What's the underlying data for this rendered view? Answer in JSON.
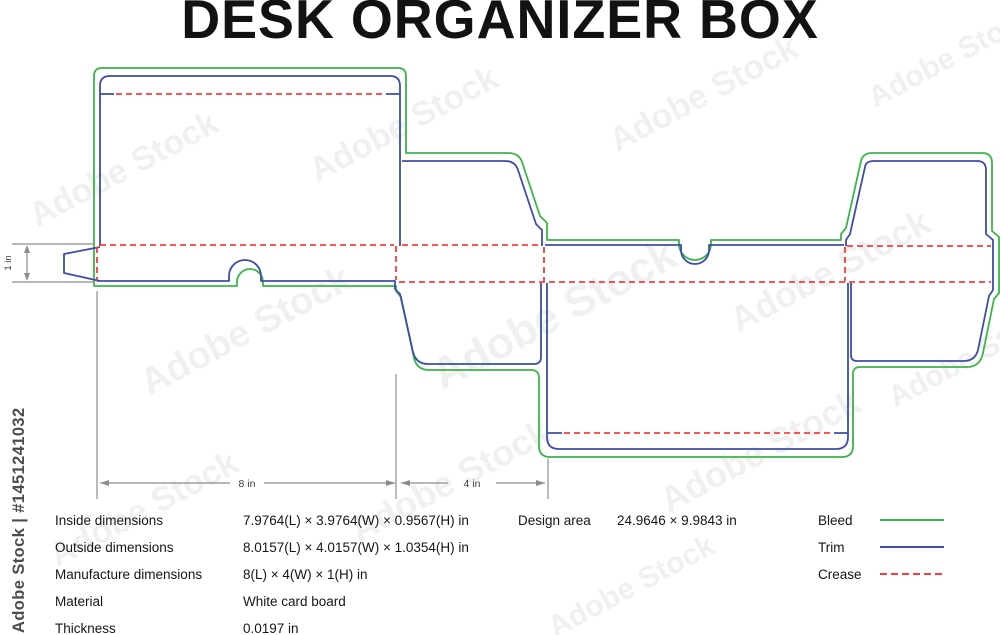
{
  "title": "DESK ORGANIZER BOX",
  "watermark": {
    "stock_text": "Adobe Stock",
    "side_label": "Adobe Stock | #1451241032"
  },
  "diagram": {
    "dimension_labels": {
      "length": "8 in",
      "width": "4 in",
      "height": "1 in"
    }
  },
  "colors": {
    "bleed": "#3bb54a",
    "trim": "#3d4da8",
    "crease": "#fb3b3b",
    "dimension": "#8c8c8c"
  },
  "specs": {
    "rows": [
      {
        "label": "Inside dimensions",
        "value": "7.9764(L) × 3.9764(W) × 0.9567(H) in"
      },
      {
        "label": "Outside dimensions",
        "value": "8.0157(L) × 4.0157(W) × 1.0354(H) in"
      },
      {
        "label": "Manufacture dimensions",
        "value": "8(L) × 4(W) × 1(H) in"
      },
      {
        "label": "Material",
        "value": "White card board"
      },
      {
        "label": "Thickness",
        "value": "0.0197 in"
      }
    ]
  },
  "design_area": {
    "label": "Design area",
    "value": "24.9646 × 9.9843 in"
  },
  "legend": {
    "items": [
      {
        "label": "Bleed",
        "style": "solid",
        "color": "#3bb54a"
      },
      {
        "label": "Trim",
        "style": "solid",
        "color": "#3d4da8"
      },
      {
        "label": "Crease",
        "style": "dashed",
        "color": "#fb3b3b"
      }
    ]
  }
}
